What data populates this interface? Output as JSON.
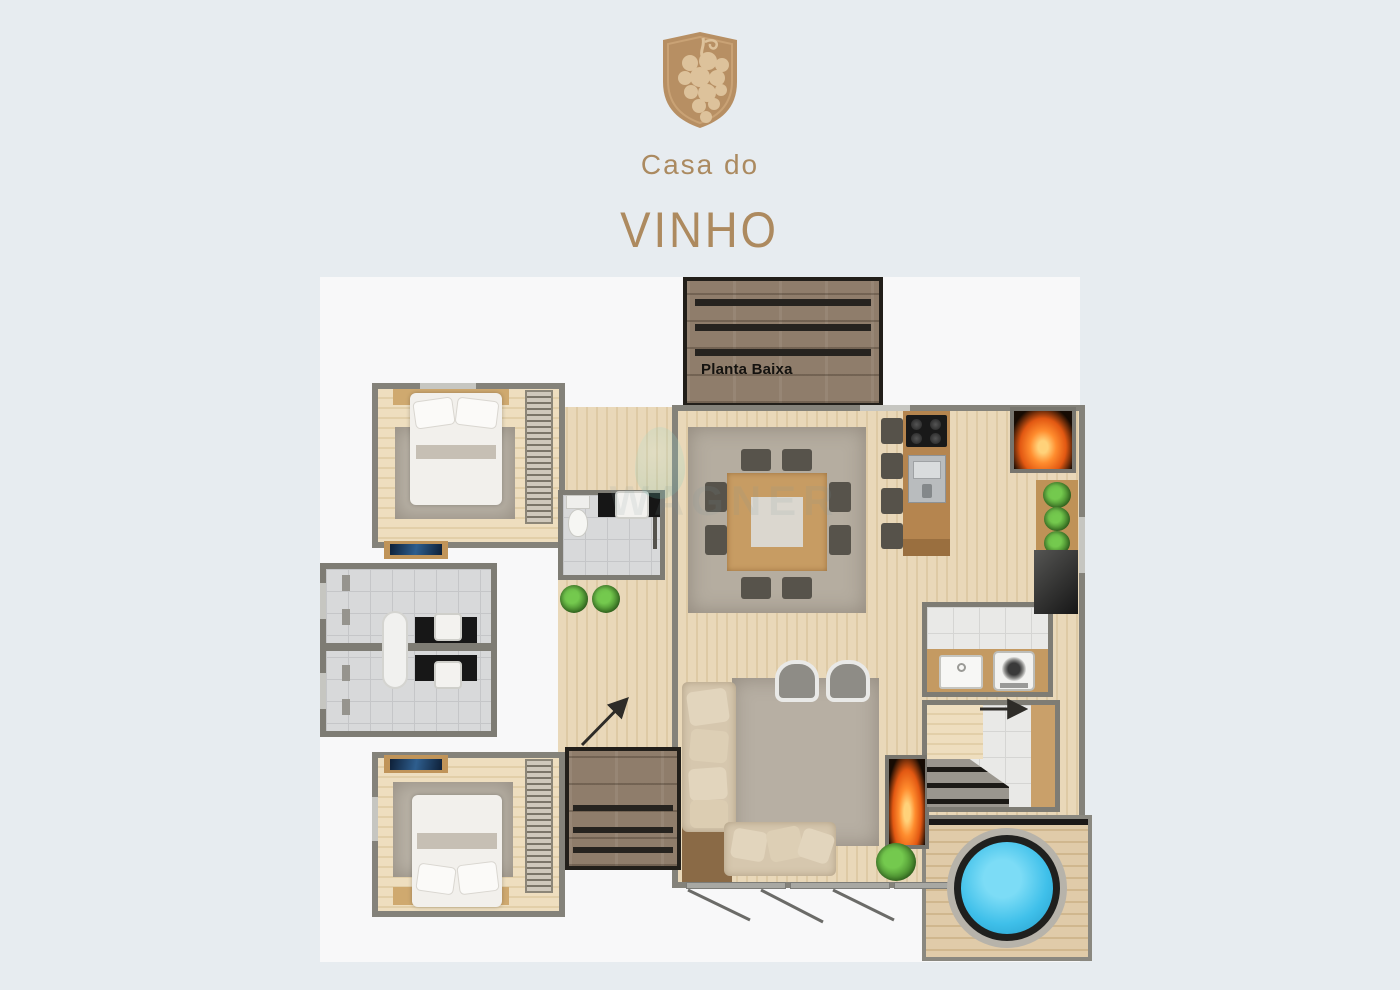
{
  "brand": {
    "line1": "Casa do",
    "line2": "VINHO",
    "logo_icon": "grape-shield",
    "color": "#b28c63"
  },
  "plan": {
    "label": "Planta Baixa",
    "watermark": "WAGNER",
    "colors": {
      "page_background": "#e7ecf0",
      "canvas_background": "#f8f8f9",
      "wall": "#84827a",
      "wood_floor": "#e6d5b5",
      "bedroom_floor": "#ecdcbd",
      "bath_tile": "#d8d9da",
      "stone_deck": "#8f7d6b",
      "rug": "#b5ada0",
      "sofa": "#d6c7ae",
      "table_wood": "#c79c63",
      "island_wood": "#b5854f",
      "fire": "#e25812",
      "plant_green": "#4b9331",
      "hot_tub_water": "#3fc0ea",
      "tv_screen": "#16304e"
    }
  }
}
